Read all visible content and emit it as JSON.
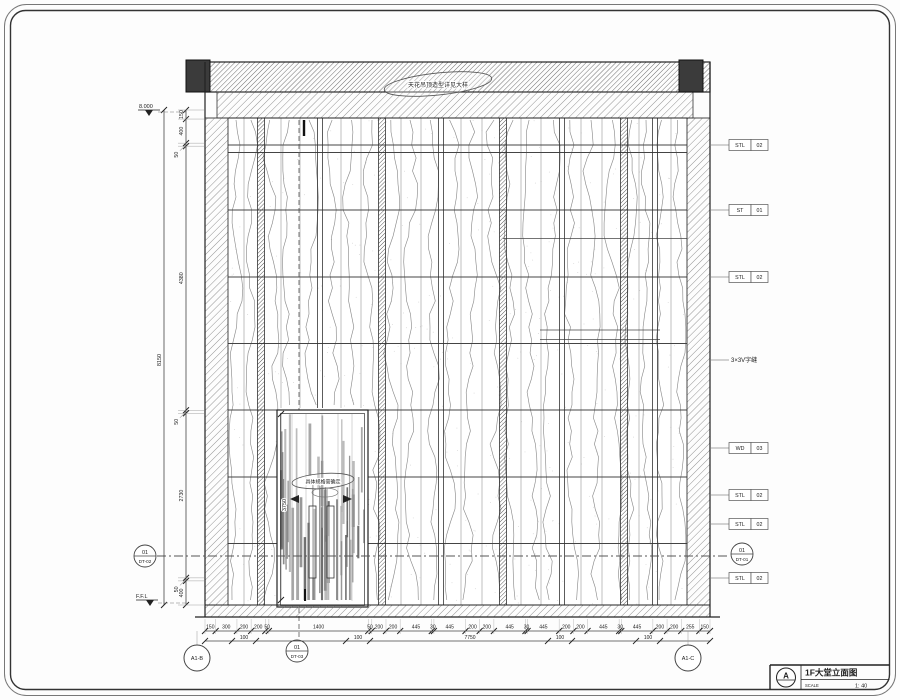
{
  "title_block": {
    "detail_letter": "A",
    "title": "1F大堂立面图",
    "scale_label": "SCALE",
    "scale_value": "1: 40"
  },
  "levels": {
    "top_level": "8.000",
    "floor_level": "F.F.L"
  },
  "clouds": {
    "ceiling_note": "天花吊顶造型详见大样",
    "door_note": "具体规格需确定"
  },
  "side_note": "3×3V字缝",
  "material_tags": [
    {
      "code": "STL",
      "num": "02"
    },
    {
      "code": "ST",
      "num": "01"
    },
    {
      "code": "STL",
      "num": "02"
    },
    {
      "code": "WD",
      "num": "03"
    },
    {
      "code": "STL",
      "num": "02"
    },
    {
      "code": "STL",
      "num": "02"
    },
    {
      "code": "STL",
      "num": "02"
    }
  ],
  "detail_refs": [
    {
      "num": "01",
      "sheet": "DT-01"
    },
    {
      "num": "01",
      "sheet": "DT-02"
    },
    {
      "num": "01",
      "sheet": "DT-03"
    }
  ],
  "grid_bubbles": [
    "A1-B",
    "A1-C"
  ],
  "dims": {
    "left_total": "8150",
    "left_chain": [
      150,
      400,
      50,
      4380,
      50,
      2730,
      50,
      400
    ],
    "door_height": "3750",
    "bottom_chain": [
      150,
      300,
      200,
      200,
      50,
      1400,
      50,
      200,
      200,
      445,
      30,
      445,
      200,
      200,
      445,
      30,
      445,
      200,
      200,
      445,
      30,
      445,
      200,
      200,
      255,
      150
    ],
    "bottom_sub": [
      "100",
      "100",
      "7750",
      "100",
      "100"
    ]
  },
  "colors": {
    "line": "#222222",
    "hatch": "#555555",
    "dark_fill": "#3b3b3b",
    "vein": "#888888"
  }
}
